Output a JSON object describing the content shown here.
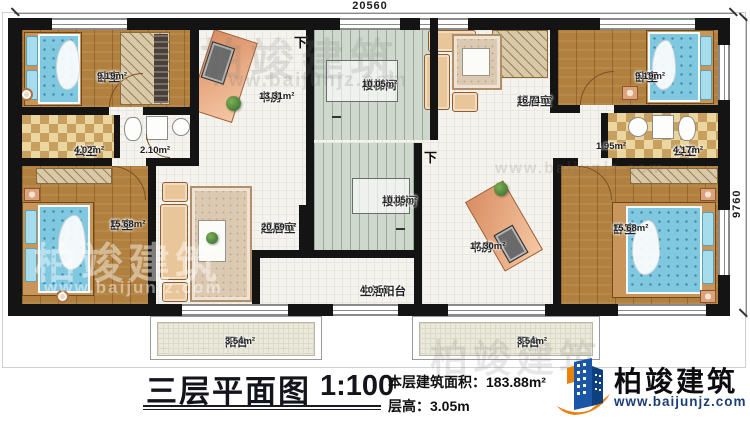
{
  "dimensions": {
    "top": "20560",
    "right": "9760"
  },
  "stairs": {
    "down_label": "下"
  },
  "rooms": [
    {
      "id": "bedroom-top-left",
      "name": "卧室",
      "area": "9.19m²"
    },
    {
      "id": "study-top",
      "name": "书房",
      "area": "13.31m²"
    },
    {
      "id": "stairwell-top",
      "name": "楼梯间",
      "area": "10.05m²"
    },
    {
      "id": "living-top",
      "name": "起居室",
      "area": "16.71m²"
    },
    {
      "id": "bedroom-top-right",
      "name": "卧室",
      "area": "9.19m²"
    },
    {
      "id": "bath-left",
      "name": "公卫",
      "area": "4.02m²"
    },
    {
      "id": "vestibule-left",
      "name": "",
      "area": "2.10m²"
    },
    {
      "id": "vestibule-right",
      "name": "",
      "area": "1.95m²"
    },
    {
      "id": "bath-right",
      "name": "公卫",
      "area": "4.17m²"
    },
    {
      "id": "bedroom-bottom-left",
      "name": "卧室",
      "area": "15.68m²"
    },
    {
      "id": "living-middle",
      "name": "起居室",
      "area": "20.69m²"
    },
    {
      "id": "stairwell-bottom",
      "name": "楼梯间",
      "area": "10.05m²"
    },
    {
      "id": "study-bottom",
      "name": "书房",
      "area": "17.30m²"
    },
    {
      "id": "bedroom-bottom-right",
      "name": "卧室",
      "area": "15.68m²"
    },
    {
      "id": "service-balcony",
      "name": "生活阳台",
      "area": "4.03m²"
    },
    {
      "id": "balcony-left",
      "name": "阳台",
      "area": "3.54m²"
    },
    {
      "id": "balcony-right",
      "name": "阳台",
      "area": "3.54m²"
    }
  ],
  "title": {
    "text": "三层平面图",
    "scale": "1:100"
  },
  "info": {
    "area_label": "本层建筑面积：",
    "area_value": "183.88m²",
    "height_label": "层高：",
    "height_value": "3.05m"
  },
  "brand": {
    "name": "柏竣建筑",
    "url": "www.baijunjz.com"
  },
  "watermark": {
    "text": "柏竣建筑",
    "url": "www.baijunjz.com"
  },
  "colors": {
    "wall": "#141414",
    "brand_blue": "#1b57a6",
    "brand_dark_blue": "#0e3f7e",
    "brand_orange": "#e8820c",
    "bed_blue": "#80c7e0",
    "wood": "#b1803e"
  }
}
